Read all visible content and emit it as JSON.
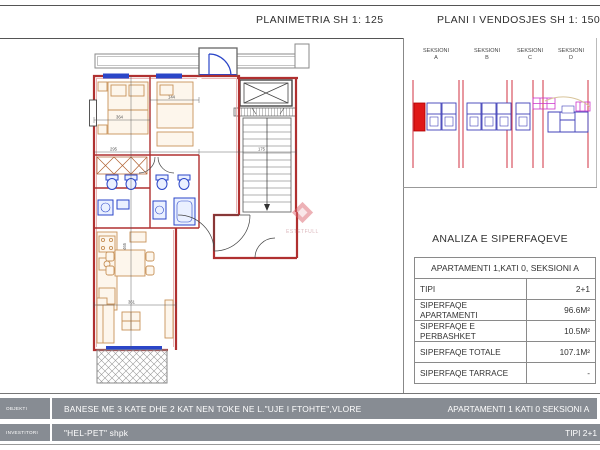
{
  "header": {
    "left_title": "PLANIMETRIA  SH 1: 125",
    "right_title": "PLANI I VENDOSJES SH 1: 1500"
  },
  "siteplan": {
    "sections": [
      {
        "name": "SEKSIONI",
        "letter": "A"
      },
      {
        "name": "SEKSIONI",
        "letter": "B"
      },
      {
        "name": "SEKSIONI",
        "letter": "C"
      },
      {
        "name": "SEKSIONI",
        "letter": "D"
      }
    ],
    "highlight_color": "#e01818",
    "unit_color": "#4040b8",
    "axis_color": "#d03040"
  },
  "analysis": {
    "title": "ANALIZA E SIPERFAQEVE",
    "header": "APARTAMENTI  1,KATI 0, SEKSIONI A",
    "rows": [
      {
        "label": "TIPI",
        "value": "2+1"
      },
      {
        "label": "SIPERFAQE APARTAMENTI",
        "value": "96.6M²"
      },
      {
        "label": "SIPERFAQE E PERBASHKET",
        "value": "10.5M²"
      },
      {
        "label": "SIPERFAQE TOTALE",
        "value": "107.1M²"
      },
      {
        "label": "SIPERFAQE TARRACE",
        "value": "-"
      }
    ]
  },
  "titleblock": {
    "row1": {
      "label": "OBJEKTI",
      "main": "BANESE ME 3 KATE DHE 2 KAT NEN TOKE NE L.\"UJE I FTOHTE\",VLORE",
      "right": "APARTAMENTI  1 KATI 0 SEKSIONI A"
    },
    "row2": {
      "label": "INVESTITORI",
      "main": "\"HEL-PET\" shpk",
      "right": "TIPI  2+1"
    },
    "bar_color": "#878c93"
  },
  "watermark": {
    "text": "ESTETFULL"
  },
  "plan": {
    "wall_color": "#b03030",
    "fixture_color": "#2b46c8",
    "furniture_color": "#c8935a",
    "dimensions": [
      "364",
      "144",
      "175",
      "295",
      "465",
      "361"
    ]
  }
}
